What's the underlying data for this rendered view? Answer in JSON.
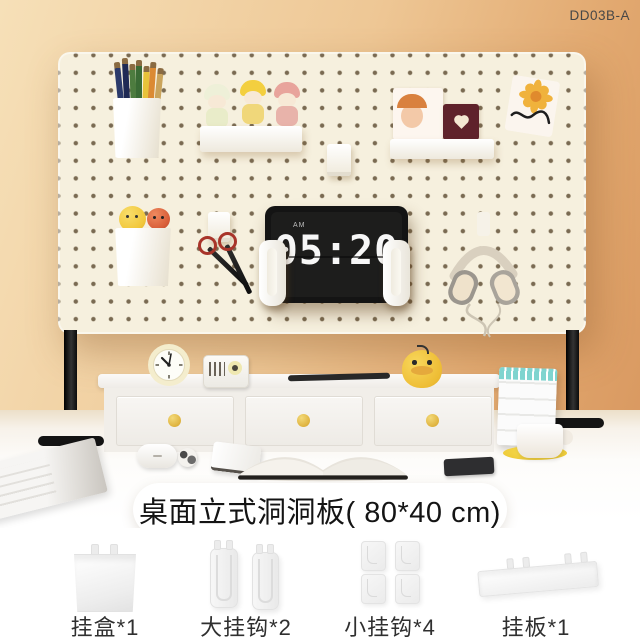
{
  "page": {
    "product_code": "DD03B-A",
    "caption": "桌面立式洞洞板( 80*40 cm)"
  },
  "pegboard_scene": {
    "clock_meridiem": "AM",
    "clock_time": "05:20"
  },
  "accessories": {
    "items": [
      {
        "name": "hanging-box",
        "label": "挂盒*1"
      },
      {
        "name": "large-hooks",
        "label": "大挂钩*2"
      },
      {
        "name": "small-hooks",
        "label": "小挂钩*4"
      },
      {
        "name": "hanging-shelf",
        "label": "挂板*1"
      }
    ]
  },
  "colors": {
    "wall_left": "#f6e0b8",
    "wall_right": "#d6935b",
    "pegboard": "#f6f0de",
    "peg_dot": "#6f5f46",
    "leg_black": "#141414",
    "drawer_knob_yellow": "#dfb33f",
    "duck_yellow": "#eebd35",
    "saucer_yellow": "#ecc52f",
    "calendar_teal": "#7fd4cf",
    "scissors_ring_red": "#a8342a",
    "card_maroon": "#5f222b",
    "label_text": "#2f2f2f"
  }
}
